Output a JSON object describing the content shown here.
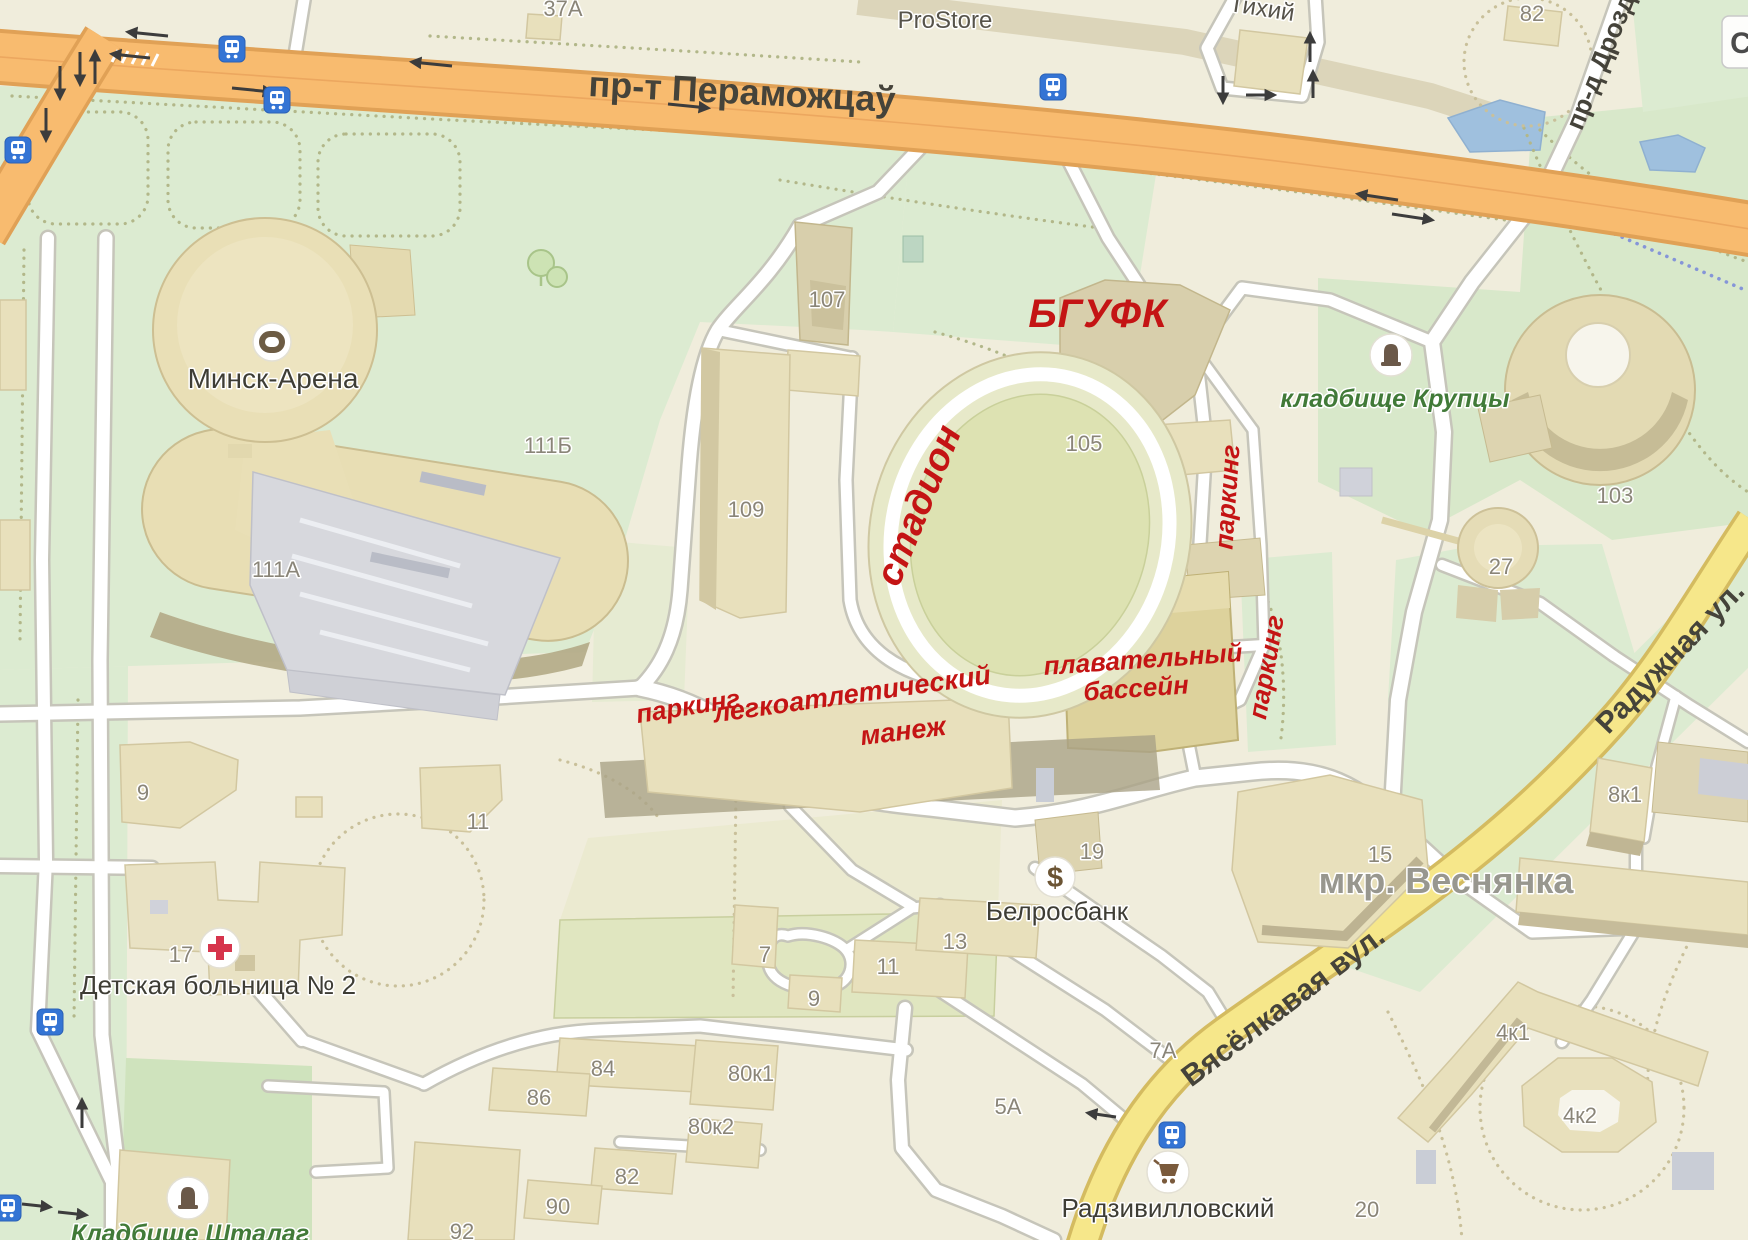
{
  "roads": {
    "peramozhtsau": "пр-т Пераможцаў",
    "drozda": "пр-д Дрозд",
    "raduzhnaya": "Радужная ул.",
    "vyaselkavaya": "Вясёлкавая вул.",
    "tihiy": "Тихий"
  },
  "places": {
    "prostore": "ProStore",
    "minsk_arena": "Минск-Арена",
    "hospital": "Детская больница № 2",
    "belrosbank": "Белросбанк",
    "radzivillovsky": "Радзивилловский",
    "vesnyanka": "мкр. Веснянка",
    "krupcy_cemetery": "кладбище Крупцы",
    "shtalag_cemetery": "Кладбище Шталаг"
  },
  "annotations": {
    "bgufk": "БГУФК",
    "stadion": "стадион",
    "parking_north": "паркинг",
    "parking_east": "паркинг",
    "parking_west": "паркинг",
    "pool_line1": "плавательный",
    "pool_line2": "бассейн",
    "athletics_line1": "легкоатлетический",
    "athletics_line2": "манеж"
  },
  "building_numbers": {
    "b37a": "37А",
    "b82_north": "82",
    "b107": "107",
    "b109": "109",
    "b105": "105",
    "b111b": "111Б",
    "b111a": "111А",
    "b103": "103",
    "b27": "27",
    "b9": "9",
    "b11": "11",
    "b17": "17",
    "b19": "19",
    "b13": "13",
    "b11_south": "11",
    "b7": "7",
    "b9_south": "9",
    "b15": "15",
    "b8k1": "8к1",
    "b7a": "7А",
    "b5a": "5А",
    "b84": "84",
    "b86": "86",
    "b80k1": "80к1",
    "b80k2": "80к2",
    "b82_south": "82",
    "b90": "90",
    "b92": "92",
    "b4k1": "4к1",
    "b4k2": "4к2",
    "b20": "20"
  },
  "icons": {
    "bank_glyph": "$"
  },
  "controls": {
    "compass_button": "С"
  },
  "colors": {
    "annotation_red": "#c41414",
    "cemetery_label_green": "#417a38",
    "main_road_orange": "#f8bb6f",
    "secondary_road_yellow": "#f6e78a",
    "transit_blue": "#3474d4",
    "park_green": "#dcebd1",
    "water_blue": "#9fc0de"
  }
}
